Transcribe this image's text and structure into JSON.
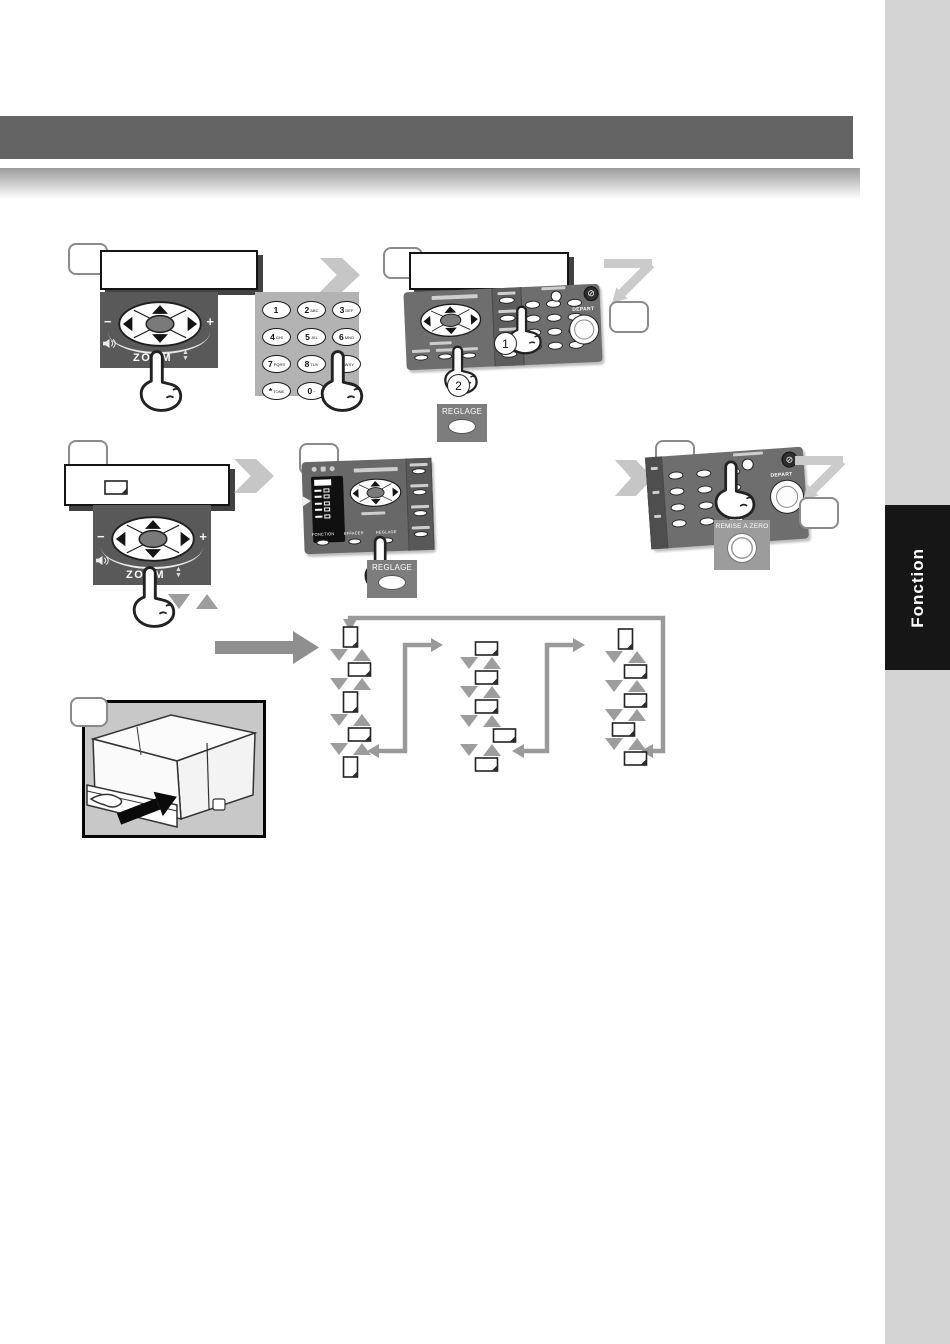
{
  "sidebar": {
    "tab_label": "Fonction"
  },
  "nav_pad": {
    "zoom_label": "ZOOM",
    "minus_label": "−",
    "plus_label": "+"
  },
  "keypad": {
    "keys": [
      {
        "digit": "1",
        "letters": ""
      },
      {
        "digit": "2",
        "letters": "ABC"
      },
      {
        "digit": "3",
        "letters": "DEF"
      },
      {
        "digit": "4",
        "letters": "GHI"
      },
      {
        "digit": "5",
        "letters": "JKL"
      },
      {
        "digit": "6",
        "letters": "MNO"
      },
      {
        "digit": "7",
        "letters": "PQRS"
      },
      {
        "digit": "8",
        "letters": "TUV"
      },
      {
        "digit": "9",
        "letters": "WXY"
      },
      {
        "digit": "*",
        "letters": "TONE"
      },
      {
        "digit": "0",
        "letters": "−"
      },
      {
        "digit": "#",
        "letters": ""
      }
    ]
  },
  "panel_step2": {
    "stop_glyph": "⊘",
    "stop_label": "STOP",
    "depart_label": "DEPART",
    "marker_1": "1",
    "marker_2": "2"
  },
  "panel_step4": {
    "button_labels": [
      "FONCTION",
      "EFFACER",
      "REGLAGE"
    ]
  },
  "panel_step5": {
    "stop_glyph": "⊘",
    "stop_label": "STOP",
    "depart_label": "DEPART"
  },
  "callouts": {
    "reglage": "REGLAGE",
    "remise_a_zero": "REMISE A ZERO"
  },
  "flow": {
    "columns": [
      {
        "items": [
          "portrait",
          "landscape",
          "portrait",
          "landscape",
          "portrait"
        ]
      },
      {
        "items": [
          "landscape",
          "landscape",
          "landscape",
          "landscape",
          "landscape"
        ]
      },
      {
        "items": [
          "portrait",
          "landscape",
          "landscape",
          "landscape",
          "landscape"
        ]
      }
    ]
  },
  "colors": {
    "header_bar": "#646464",
    "sidebar": "#d4d4d4",
    "tab_bg": "#161616",
    "nav_panel": "#595959",
    "keypad_panel": "#b3b3b3",
    "control_panel": "#6e6e6e",
    "arrow_gray": "#c6c6c6",
    "flow_line": "#999999"
  }
}
